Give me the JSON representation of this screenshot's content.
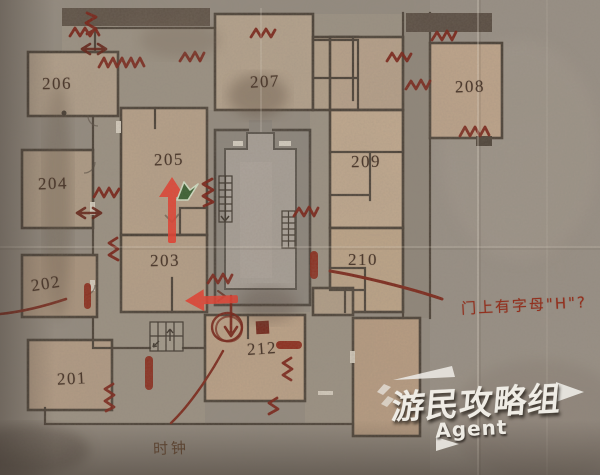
{
  "watermark": {
    "main": "游民攻略组",
    "sub": "Agent"
  },
  "annotations": {
    "door_letter_note": "门上有字母\"H\"?",
    "clock_note": "时钟"
  },
  "rooms": {
    "r201": "201",
    "r202": "202",
    "r203": "203",
    "r204": "204",
    "r205": "205",
    "r206": "206",
    "r207": "207",
    "r208": "208",
    "r209": "209",
    "r210": "210",
    "r212": "212"
  },
  "colors": {
    "paper": "#8f877c",
    "corridor": "#9a9184",
    "room_fill": "#b8a28a",
    "wall": "#473e34",
    "ink_red": "#77190e",
    "route_arrow_red": "#ee3526",
    "player_marker_green": "#315c2b",
    "note_red": "#93301e",
    "label_brown": "#4d3b2f"
  },
  "icon_semantics": {
    "zigzag": "jammed-door-mark",
    "capsule": "blocked-door-mark",
    "double_arrow": "two-way-passage-mark",
    "circle_down_arrow": "descend-point-mark",
    "red_arrow": "route-arrow",
    "green_cursor": "player-position-marker",
    "ladder_grid": "staircase-icon"
  }
}
